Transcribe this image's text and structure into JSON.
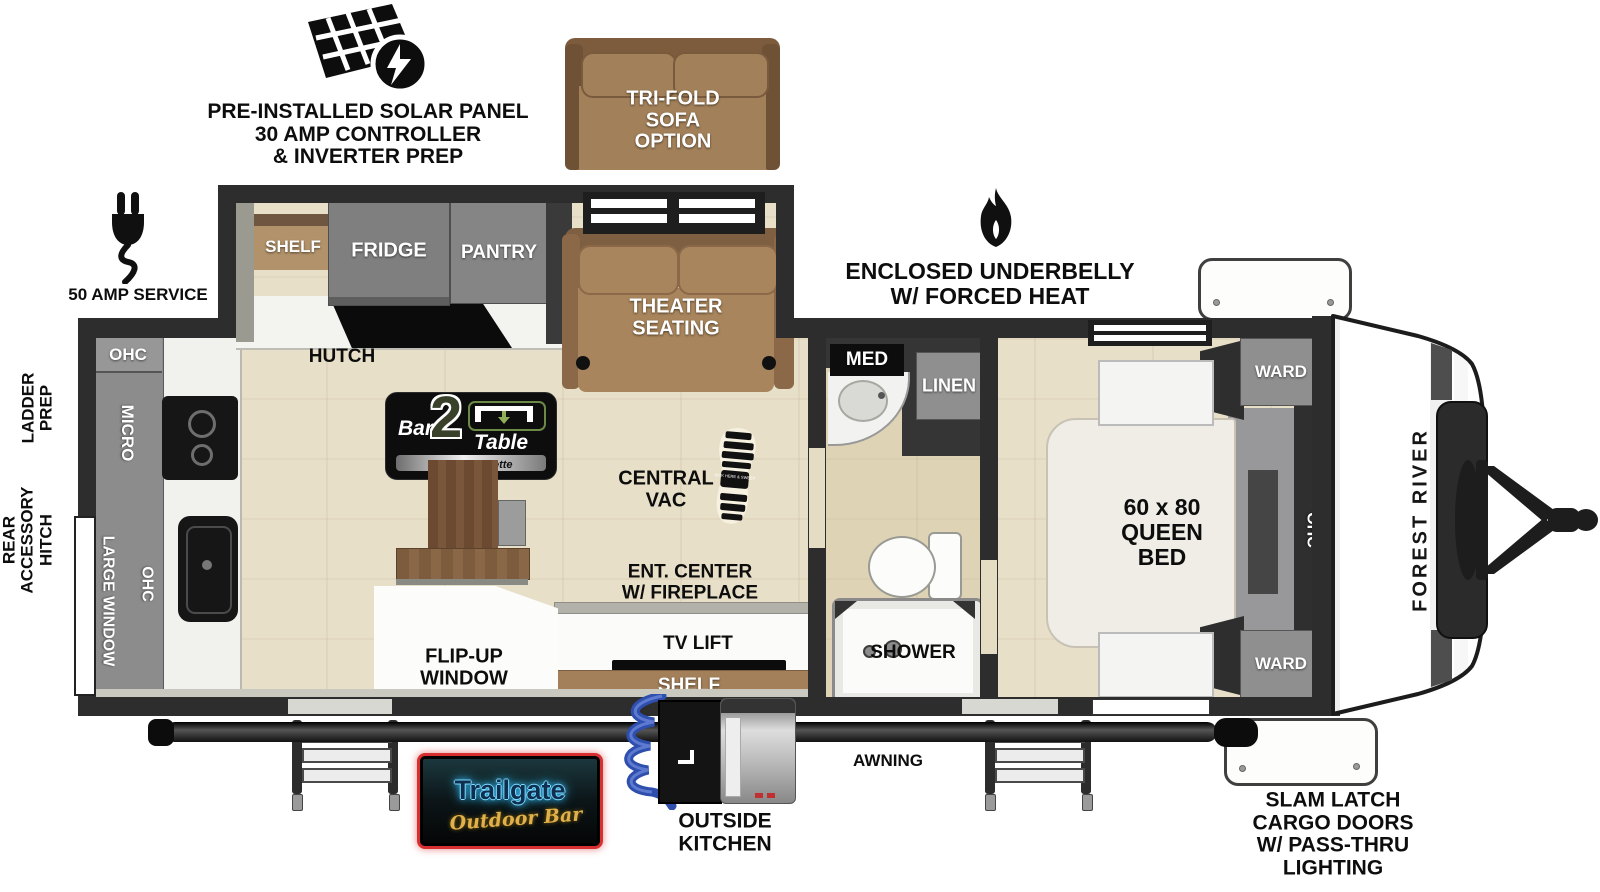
{
  "annotations": {
    "solar1": "PRE-INSTALLED SOLAR PANEL",
    "solar2": "30 AMP CONTROLLER",
    "solar3": "& INVERTER PREP",
    "amp_service": "50 AMP SERVICE",
    "underbelly1": "ENCLOSED UNDERBELLY",
    "underbelly2": "W/ FORCED HEAT",
    "ladder1": "LADDER",
    "ladder2": "PREP",
    "rear1": "REAR",
    "rear2": "ACCESSORY",
    "rear3": "HITCH",
    "awning": "AWNING",
    "outside1": "OUTSIDE",
    "outside2": "KITCHEN",
    "cargo1": "SLAM LATCH",
    "cargo2": "CARGO DOORS",
    "cargo3": "W/ PASS-THRU",
    "cargo4": "LIGHTING",
    "brand": "FOREST RIVER"
  },
  "sofa_option": {
    "line1": "TRI-FOLD",
    "line2": "SOFA",
    "line3": "OPTION"
  },
  "living": {
    "shelf": "SHELF",
    "fridge": "FRIDGE",
    "pantry": "PANTRY",
    "hutch": "HUTCH",
    "theater1": "THEATER",
    "theater2": "SEATING",
    "vac1": "CENTRAL",
    "vac2": "VAC",
    "vac_boot": "KICK HERE & SWEEP",
    "ent1": "ENT. CENTER",
    "ent2": "W/ FIREPLACE",
    "tv_lift": "TV LIFT",
    "shelf_bottom": "SHELF",
    "flip1": "FLIP-UP",
    "flip2": "WINDOW"
  },
  "kitchen": {
    "ohc_top": "OHC",
    "micro": "MICRO",
    "large_window": "LARGE WINDOW",
    "ohc_side": "OHC"
  },
  "bath": {
    "med": "MED",
    "linen": "LINEN",
    "shower": "SHOWER"
  },
  "bedroom": {
    "bed1": "60 x 80",
    "bed2": "QUEEN",
    "bed3": "BED",
    "ward_top": "WARD",
    "ward_bottom": "WARD",
    "ohc": "OHC"
  },
  "logos": {
    "bar2table": {
      "bar": "Bar",
      "num": "2",
      "table": "Table",
      "sub": "Pull-Out Dinette"
    },
    "trailgate": {
      "name": "Trailgate",
      "sub": "Outdoor Bar"
    }
  },
  "colors": {
    "wall": "#2d2d2d",
    "floor": "#e8dfc8",
    "cabinet": "#8a8a8a",
    "accent_brown": "#a5825a",
    "logo_green": "#6a8a46",
    "neon_red": "#d83030",
    "neon_blue": "#4fc9ff",
    "gold": "#e2b04a"
  }
}
